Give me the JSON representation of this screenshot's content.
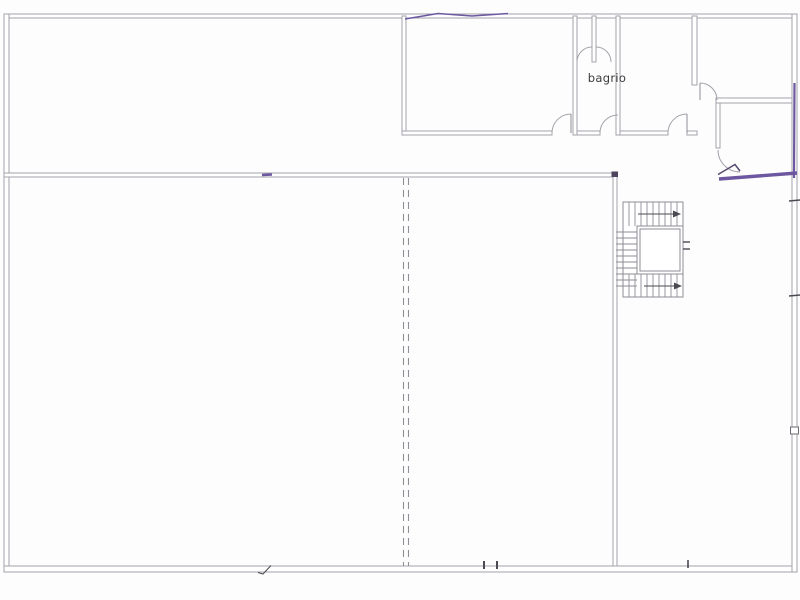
{
  "plan": {
    "room_label": "bagrio"
  },
  "colors": {
    "wall_line": "#a3a3ab",
    "wall_dark": "#8e8e96",
    "annotation_purple": "#6d57a0",
    "annotation_dark": "#4e4460",
    "label_text": "#3b3b3b",
    "mark_dark": "#4a4a52",
    "background": "#fdfdfd"
  }
}
